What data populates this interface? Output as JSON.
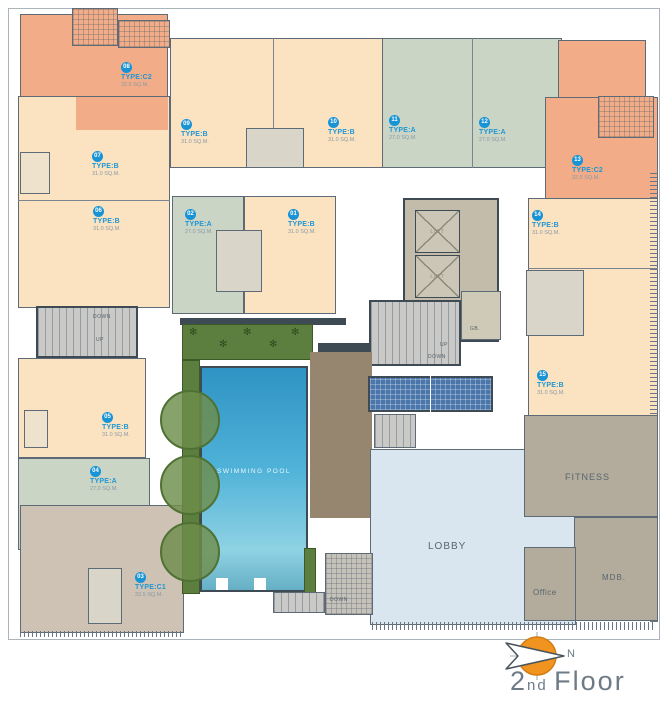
{
  "title": "2nd Floor floor plan",
  "floor_title": {
    "number": "2",
    "ordinal": "nd",
    "word": "Floor"
  },
  "compass": {
    "label": "N"
  },
  "units": [
    {
      "no": "01",
      "type": "TYPE:B",
      "area": "31.0 SQ.M."
    },
    {
      "no": "02",
      "type": "TYPE:A",
      "area": "27.0 SQ.M."
    },
    {
      "no": "03",
      "type": "TYPE:C1",
      "area": "33.5 SQ.M."
    },
    {
      "no": "04",
      "type": "TYPE:A",
      "area": "27.0 SQ.M."
    },
    {
      "no": "05",
      "type": "TYPE:B",
      "area": "31.0 SQ.M."
    },
    {
      "no": "06",
      "type": "TYPE:B",
      "area": "31.0 SQ.M."
    },
    {
      "no": "07",
      "type": "TYPE:B",
      "area": "31.0 SQ.M."
    },
    {
      "no": "08",
      "type": "TYPE:C2",
      "area": "32.5 SQ.M."
    },
    {
      "no": "09",
      "type": "TYPE:B",
      "area": "31.0 SQ.M."
    },
    {
      "no": "10",
      "type": "TYPE:B",
      "area": "31.0 SQ.M."
    },
    {
      "no": "11",
      "type": "TYPE:A",
      "area": "27.0 SQ.M."
    },
    {
      "no": "12",
      "type": "TYPE:A",
      "area": "27.0 SQ.M."
    },
    {
      "no": "13",
      "type": "TYPE:C2",
      "area": "32.5 SQ.M."
    },
    {
      "no": "14",
      "type": "TYPE:B",
      "area": "31.0 SQ.M."
    },
    {
      "no": "15",
      "type": "TYPE:B",
      "area": "31.0 SQ.M."
    }
  ],
  "rooms": {
    "swimming_pool": "SWIMMING POOL",
    "lobby": "LOBBY",
    "fitness": "FITNESS",
    "office": "Office",
    "mdb": "MDB.",
    "gb": "GB.",
    "lift": "LIFT"
  },
  "stairs": {
    "up": "UP",
    "down": "DOWN"
  },
  "icons": [
    "compass-icon",
    "palm-icon",
    "tree-icon"
  ],
  "colors": {
    "type_a": "#cbd5c5",
    "type_b": "#fbe3c1",
    "type_c1": "#cdc2b4",
    "type_c2": "#f2ac87",
    "amenity": "#b3ab9b",
    "lobby": "#d9e6ef",
    "pool": "#2f93c4",
    "planter": "#5c7f40",
    "deck": "#97866f",
    "restroom_tile": "#4a76ab",
    "wall": "#3e4a54",
    "unit_badge": "#1793d6",
    "compass": "#f0931f"
  }
}
